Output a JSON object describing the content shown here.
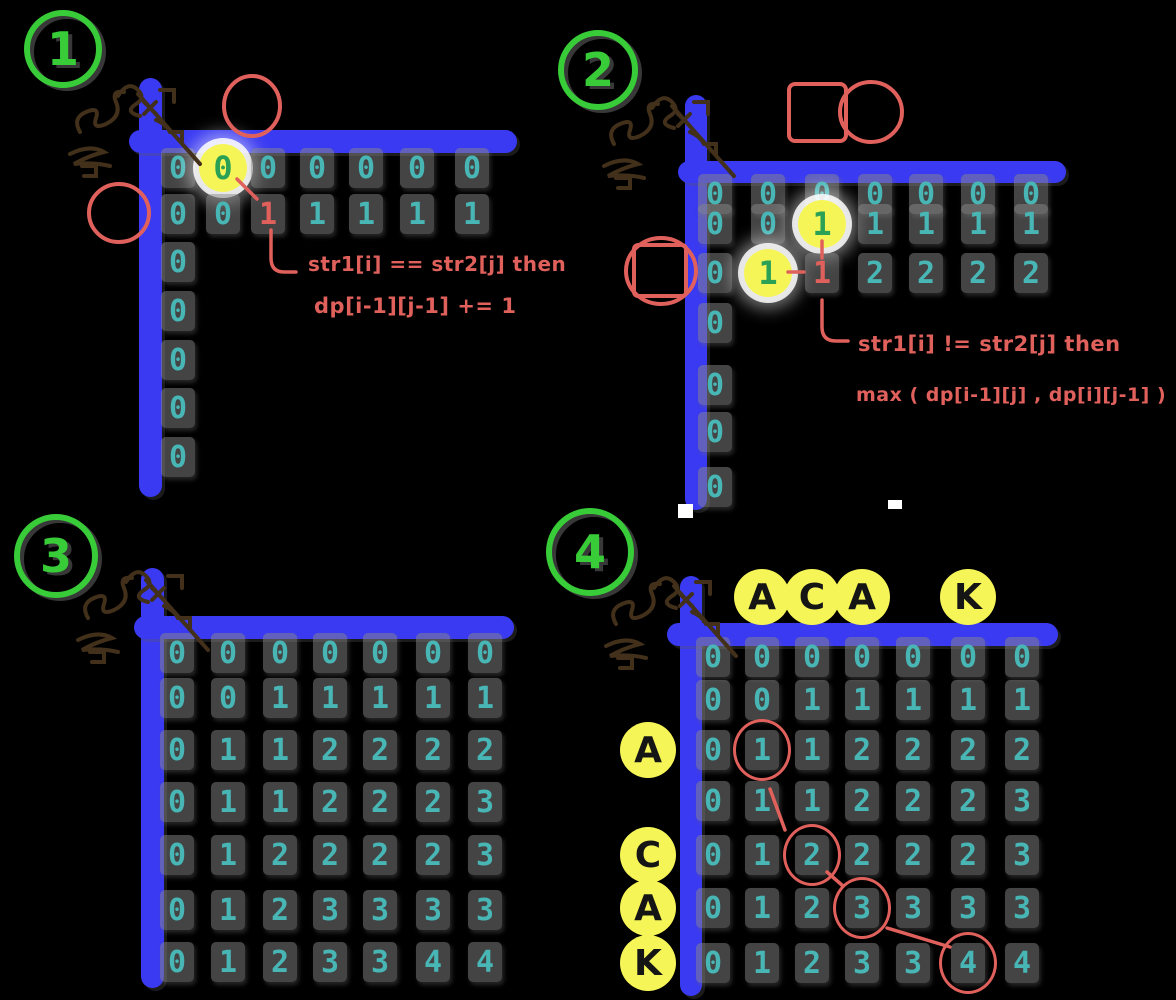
{
  "app": {
    "background": "#000000"
  },
  "colors": {
    "axis_blue": "#3a3af2",
    "digit_teal": "#49b6b6",
    "annotation_red": "#e0605c",
    "badge_green": "#38cc38",
    "highlight_digit_green": "#2ba155",
    "highlight_yellow": "#f6f558",
    "scribble_brown": "#42301a"
  },
  "panels": [
    {
      "step": "1",
      "notes": [
        "str1[i] == str2[j] then",
        "dp[i-1][j-1] += 1"
      ],
      "grid": {
        "rows": [
          [
            "0",
            "0",
            "0",
            "0",
            "0",
            "0",
            "0"
          ],
          [
            "0",
            "0",
            "1",
            "1",
            "1",
            "1",
            "1"
          ],
          [
            "0",
            "",
            "",
            "",
            "",
            "",
            ""
          ],
          [
            "0",
            "",
            "",
            "",
            "",
            "",
            ""
          ],
          [
            "0",
            "",
            "",
            "",
            "",
            "",
            ""
          ],
          [
            "0",
            "",
            "",
            "",
            "",
            "",
            ""
          ],
          [
            "0",
            "",
            "",
            "",
            "",
            "",
            ""
          ]
        ]
      },
      "marks": [
        {
          "r": 0,
          "c": 1,
          "kind": "focus"
        },
        {
          "r": 1,
          "c": 2,
          "kind": "red"
        }
      ]
    },
    {
      "step": "2",
      "notes": [
        "str1[i] != str2[j] then",
        "max ( dp[i-1][j] , dp[i][j-1] )"
      ],
      "grid": {
        "rows": [
          [
            "0",
            "0",
            "0",
            "0",
            "0",
            "0",
            "0"
          ],
          [
            "0",
            "0",
            "1",
            "1",
            "1",
            "1",
            "1"
          ],
          [
            "0",
            "1",
            "1",
            "2",
            "2",
            "2",
            "2"
          ],
          [
            "0",
            "",
            "",
            "",
            "",
            "",
            ""
          ],
          [
            "0",
            "",
            "",
            "",
            "",
            "",
            ""
          ],
          [
            "0",
            "",
            "",
            "",
            "",
            "",
            ""
          ],
          [
            "0",
            "",
            "",
            "",
            "",
            "",
            ""
          ]
        ]
      },
      "marks": [
        {
          "r": 1,
          "c": 2,
          "kind": "focus"
        },
        {
          "r": 2,
          "c": 1,
          "kind": "focus"
        },
        {
          "r": 2,
          "c": 2,
          "kind": "red"
        }
      ]
    },
    {
      "step": "3",
      "notes": [],
      "grid": {
        "rows": [
          [
            "0",
            "0",
            "0",
            "0",
            "0",
            "0",
            "0"
          ],
          [
            "0",
            "0",
            "1",
            "1",
            "1",
            "1",
            "1"
          ],
          [
            "0",
            "1",
            "1",
            "2",
            "2",
            "2",
            "2"
          ],
          [
            "0",
            "1",
            "1",
            "2",
            "2",
            "2",
            "3"
          ],
          [
            "0",
            "1",
            "2",
            "2",
            "2",
            "2",
            "3"
          ],
          [
            "0",
            "1",
            "2",
            "3",
            "3",
            "3",
            "3"
          ],
          [
            "0",
            "1",
            "2",
            "3",
            "3",
            "4",
            "4"
          ]
        ]
      },
      "marks": []
    },
    {
      "step": "4",
      "notes": [],
      "grid": {
        "rows": [
          [
            "0",
            "0",
            "0",
            "0",
            "0",
            "0",
            "0"
          ],
          [
            "0",
            "0",
            "1",
            "1",
            "1",
            "1",
            "1"
          ],
          [
            "0",
            "1",
            "1",
            "2",
            "2",
            "2",
            "2"
          ],
          [
            "0",
            "1",
            "1",
            "2",
            "2",
            "2",
            "3"
          ],
          [
            "0",
            "1",
            "2",
            "2",
            "2",
            "2",
            "3"
          ],
          [
            "0",
            "1",
            "2",
            "3",
            "3",
            "3",
            "3"
          ],
          [
            "0",
            "1",
            "2",
            "3",
            "3",
            "4",
            "4"
          ]
        ]
      },
      "marks": [
        {
          "r": 2,
          "c": 1,
          "kind": "ring"
        },
        {
          "r": 4,
          "c": 2,
          "kind": "ring"
        },
        {
          "r": 5,
          "c": 3,
          "kind": "ring"
        },
        {
          "r": 6,
          "c": 5,
          "kind": "ring"
        }
      ],
      "top_letters": [
        {
          "ch": "A",
          "col": 1
        },
        {
          "ch": "C",
          "col": 2
        },
        {
          "ch": "A",
          "col": 3
        },
        {
          "ch": "K",
          "col": 5
        }
      ],
      "left_letters": [
        {
          "ch": "A",
          "row": 2
        },
        {
          "ch": "C",
          "row": 4
        },
        {
          "ch": "A",
          "row": 5
        },
        {
          "ch": "K",
          "row": 6
        }
      ]
    }
  ]
}
